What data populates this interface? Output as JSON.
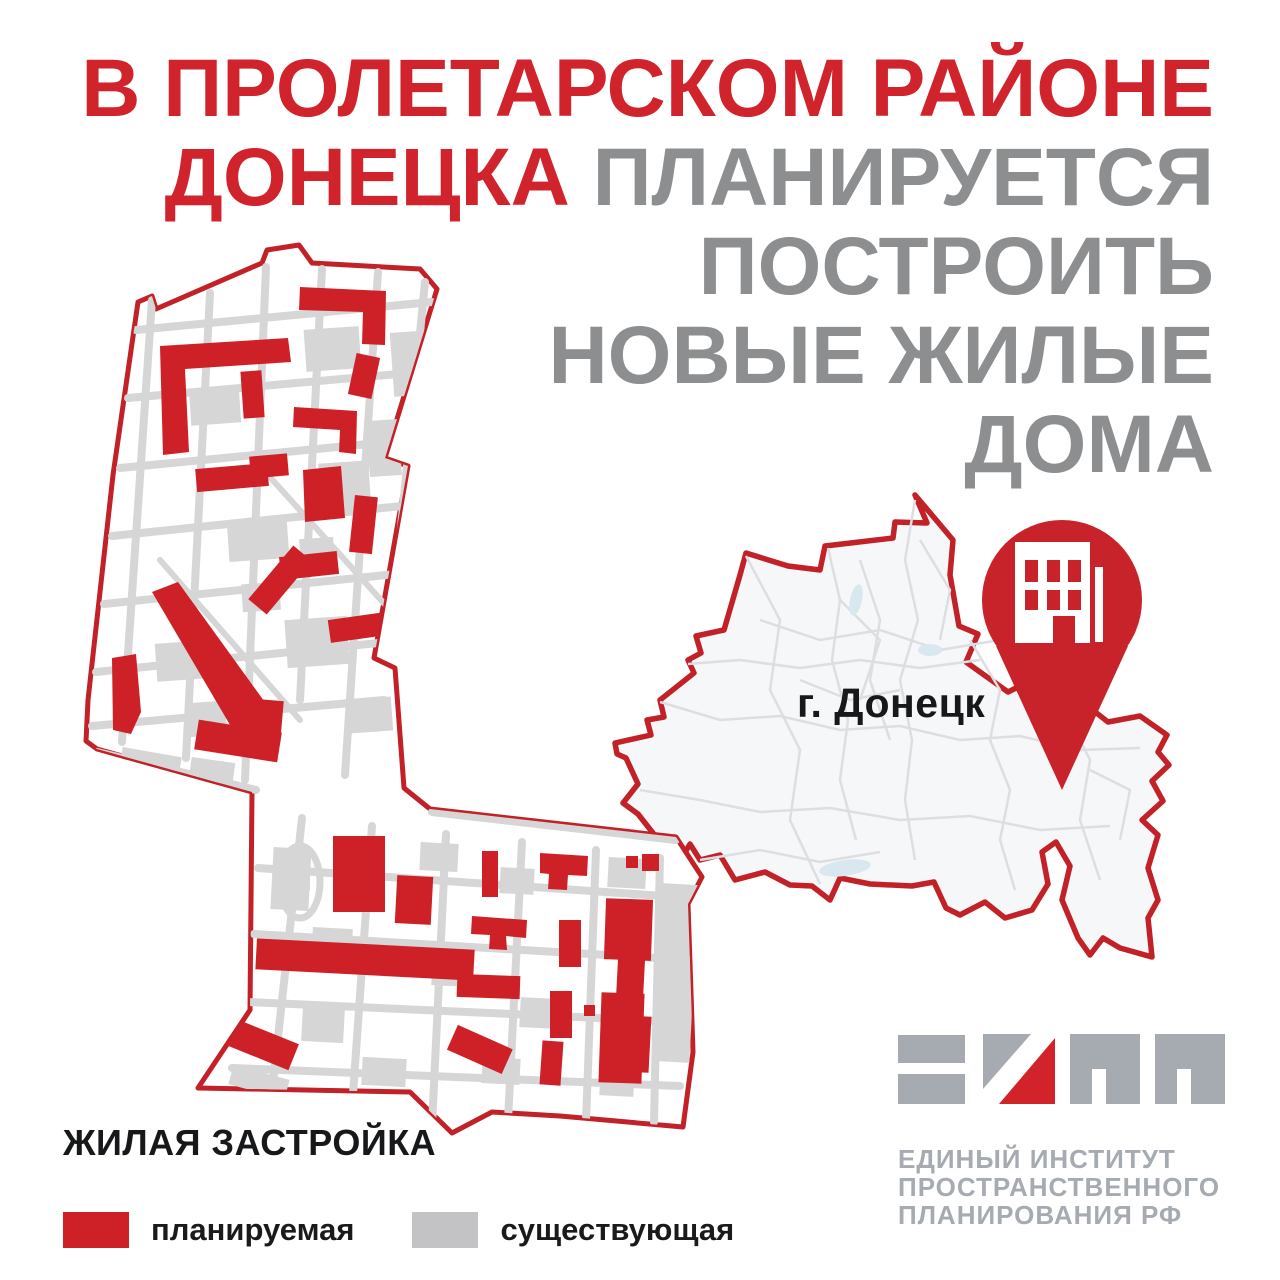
{
  "poster": {
    "headline": {
      "line1_red": "В ПРОЛЕТАРСКОМ РАЙОНЕ",
      "line2_red": "ДОНЕЦКА",
      "line2_gray": "ПЛАНИРУЕТСЯ",
      "line3_gray": "ПОСТРОИТЬ",
      "line4_gray": "НОВЫЕ ЖИЛЫЕ",
      "line5_gray": "ДОМА"
    },
    "city_map": {
      "label": "г. Донецк",
      "pin_icon": "map-pin-with-building-icon"
    },
    "district_map_icon": "district-plan-map",
    "legend": {
      "title": "ЖИЛАЯ ЗАСТРОЙКА",
      "items": [
        {
          "label": "планируемая",
          "color": "#CE2127"
        },
        {
          "label": "существующая",
          "color": "#C3C3C5"
        }
      ]
    },
    "logo": {
      "mark_icon": "eipp-logo-mark",
      "line1": "ЕДИНЫЙ ИНСТИТУТ",
      "line2": "ПРОСТРАНСТВЕННОГО",
      "line3": "ПЛАНИРОВАНИЯ РФ"
    },
    "colors": {
      "headline_red": "#D0232B",
      "headline_gray": "#8C8E90",
      "planned_red": "#CE2127",
      "existing_gray": "#D6D6D7",
      "boundary_red": "#C22127",
      "city_fill": "#F6F7F8",
      "logo_gray": "#A6ABB2",
      "text_black": "#17181A"
    }
  }
}
